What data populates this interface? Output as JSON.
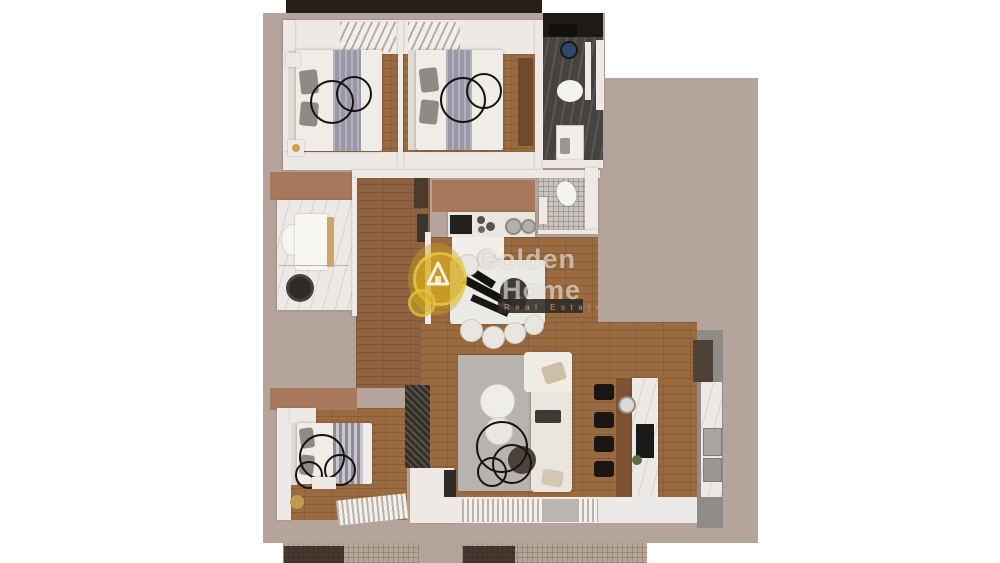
{
  "watermark": {
    "brand_line1": "Golden",
    "brand_line2": "Home",
    "tagline": "Real Estate",
    "logo": "gold-circle-house-icon"
  },
  "palette": {
    "page_background": "#ffffff",
    "wall_taupe": "#b4a49b",
    "wall_white": "#eee9e4",
    "top_balcony_dark": "#261e18",
    "wood_floor": "#9a6a41",
    "wood_floor_hall": "#8f6340",
    "accent_brown_closet": "#a7785c",
    "dark_marble_bath": "#46423f",
    "light_marble_bath": "#edeae6",
    "wc_tile_gray": "#c8c5c1",
    "rug_gray": "#b7b3af",
    "sofa_cream": "#eae6df",
    "island_marble": "#eceae6",
    "island_wood_bar": "#7c5232",
    "stool_black": "#191613",
    "cabinet_gray": "#8f8b86",
    "cabinet_dark_wood": "#4e4238",
    "balcony_tile": "#b5a698",
    "logo_gold": "rgba(214,174,30,0.6)",
    "ring_decor_black": "#17140f",
    "blanket_lavender": "#9b97a8"
  },
  "floor_plan": {
    "type": "apartment-3d-top-view",
    "rooms": [
      "bedroom-top-left",
      "bedroom-top-middle",
      "bathroom-dark-top-right",
      "bathroom-marble-left",
      "wc-center",
      "hallway-center",
      "kitchen-center",
      "dining-area",
      "living-room",
      "kitchen-island-area",
      "bedroom-bottom-left",
      "balcony-bottom-left",
      "balcony-bottom-right",
      "balcony-top"
    ],
    "furniture": [
      "double-bed-x3",
      "ring-light-decor",
      "toilet-x2",
      "washing-machine",
      "vanity-sink",
      "cooktop",
      "kitchen-sink",
      "dining-table",
      "dining-chairs",
      "sofa",
      "coffee-tables",
      "ottoman",
      "bar-stools-x4",
      "kitchen-island",
      "tall-cabinets",
      "wardrobes",
      "area-rug",
      "window-blinds"
    ]
  }
}
